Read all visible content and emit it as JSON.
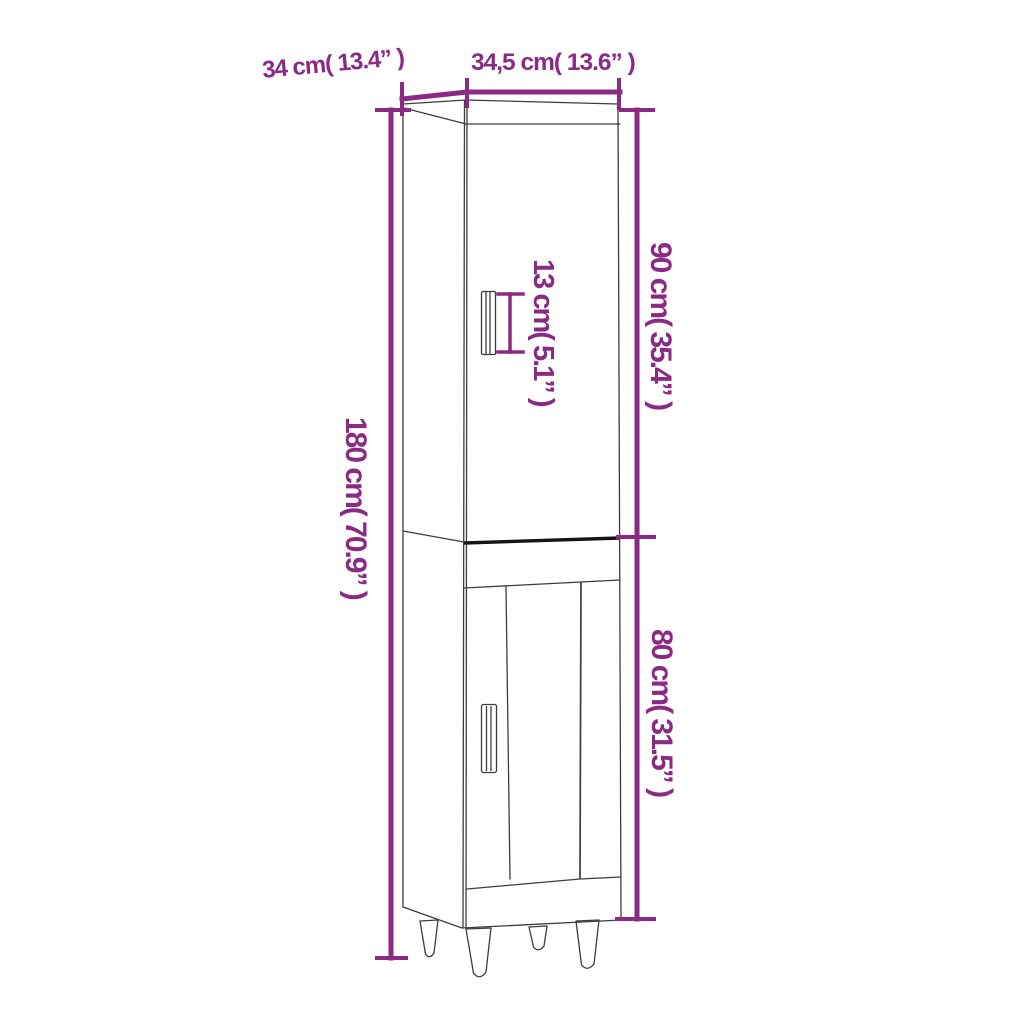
{
  "diagram_type": "furniture-dimension-diagram",
  "labels": {
    "depth": "34 cm( 13.4” )",
    "width": "34,5 cm( 13.6” )",
    "total_height": "180 cm( 70.9” )",
    "upper_height": "90 cm( 35.4” )",
    "lower_height": "80 cm( 31.5” )",
    "handle_height": "13 cm( 5.1” )"
  },
  "measurements": {
    "depth_cm": 34,
    "depth_in": 13.4,
    "width_cm": 34.5,
    "width_in": 13.6,
    "total_height_cm": 180,
    "total_height_in": 70.9,
    "upper_height_cm": 90,
    "upper_height_in": 35.4,
    "lower_height_cm": 80,
    "lower_height_in": 31.5,
    "handle_height_cm": 13,
    "handle_height_in": 5.1
  },
  "colors": {
    "dimension_purple": "#8B2A85",
    "outline_gray": "#3D3D3D",
    "divider_black": "#151515",
    "background": "#FFFFFF"
  }
}
